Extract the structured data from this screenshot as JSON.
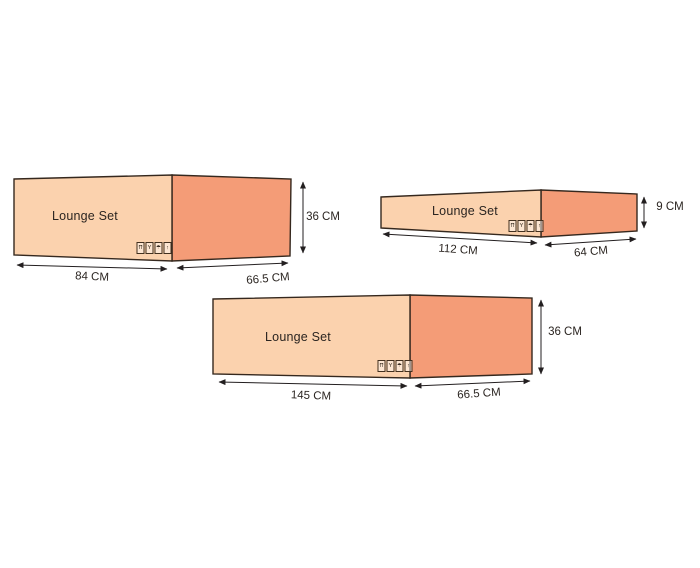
{
  "colors": {
    "background": "#ffffff",
    "front_face": "#FBD2AE",
    "side_face": "#F49C77",
    "outline": "#35281E",
    "dimension_line": "#231F20",
    "label_text": "#2B2521"
  },
  "boxes": [
    {
      "label": "Lounge Set",
      "width": "84 CM",
      "depth": "66.5 CM",
      "height": "36 CM"
    },
    {
      "label": "Lounge Set",
      "width": "112 CM",
      "depth": "64 CM",
      "height": "9 CM"
    },
    {
      "label": "Lounge Set",
      "width": "145 CM",
      "depth": "66.5 CM",
      "height": "36 CM"
    }
  ],
  "handling_icons": [
    {
      "name": "this-way-up-icon",
      "glyph": "⇈"
    },
    {
      "name": "fragile-icon",
      "glyph": "Y"
    },
    {
      "name": "keep-dry-icon",
      "glyph": "☂"
    },
    {
      "name": "up-arrow-icon",
      "glyph": "↑"
    }
  ]
}
